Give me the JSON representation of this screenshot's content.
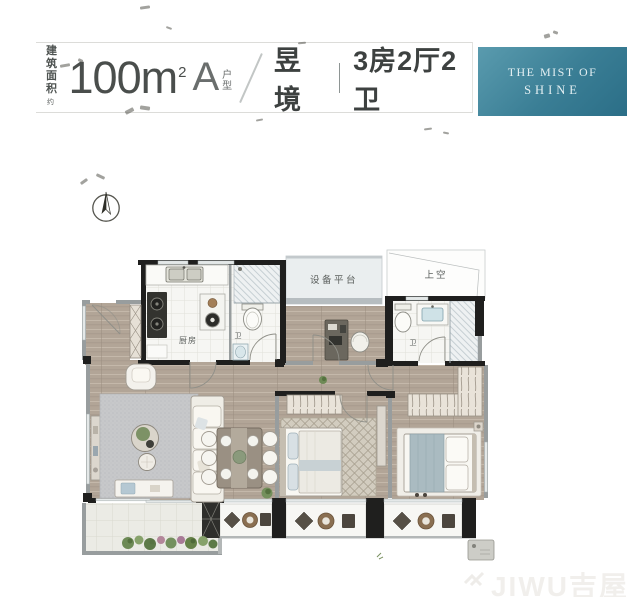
{
  "header": {
    "area_label_top": "建筑",
    "area_label_bottom": "面积",
    "area_approx_mark": "约",
    "area_value": "100",
    "area_unit_base": "m",
    "area_unit_sup": "2",
    "unit_type_letter": "A",
    "unit_type_top": "户",
    "unit_type_bottom": "型",
    "project_name": "昱境",
    "layout_spec": "3房2厅2卫"
  },
  "badge": {
    "line1": "THE MIST OF",
    "line2": "SHINE"
  },
  "floorplan": {
    "rooms": {
      "kitchen": "厨房",
      "equipment_platform": "设备平台",
      "open_above": "上空",
      "bath_main": "卫",
      "bath_second": "卫"
    }
  },
  "watermark": {
    "brand": "JIWU吉屋"
  },
  "colors": {
    "badge_gradient_start": "#5a9bae",
    "badge_gradient_end": "#2b6e87",
    "wall_black": "#1f1f1e",
    "wall_gray": "#989d9e",
    "wood_floor": "#b2a597",
    "tile_floor": "#f6f6f3",
    "rug_gray": "#c7c8ca",
    "duvet_blue": "#aabbc1",
    "plant_green": "#74905e"
  }
}
